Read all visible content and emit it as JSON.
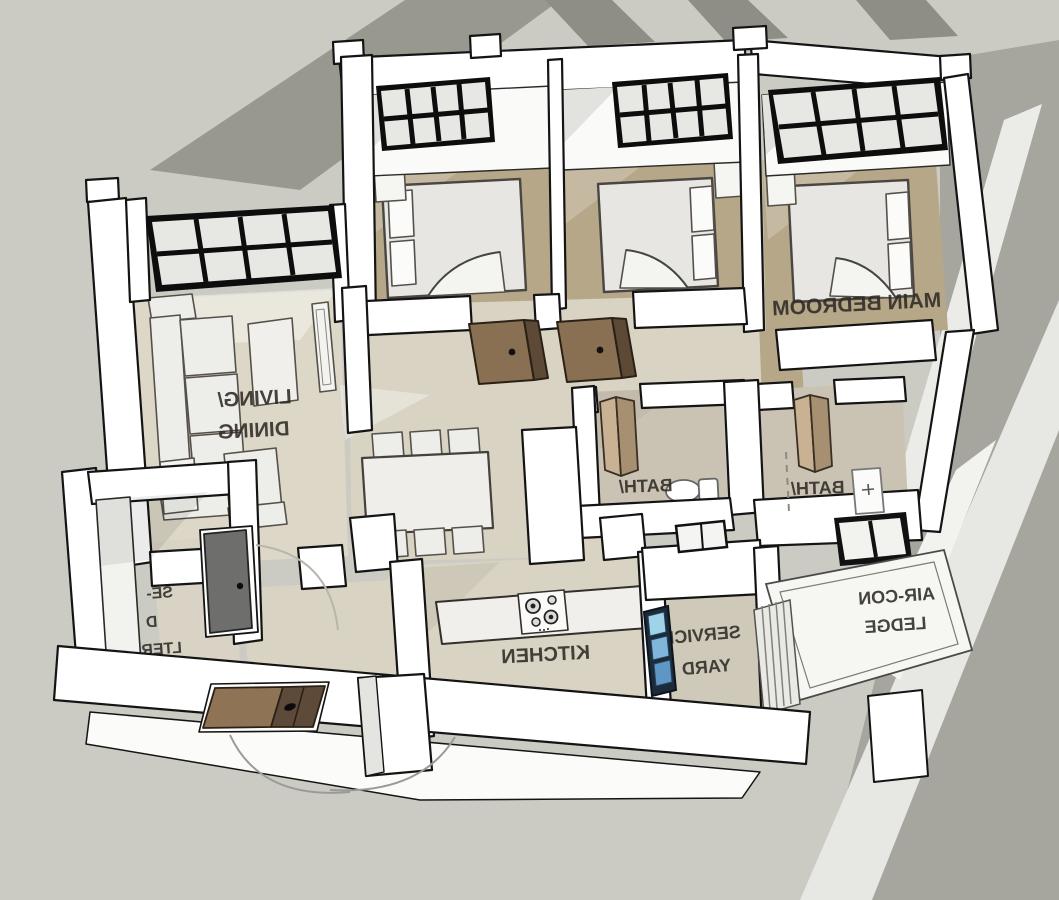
{
  "scene": {
    "type": "3d-isometric-floor-plan",
    "style": "sketchup-render, horizontally mirrored text",
    "rooms_visible": [
      "LIVING/ DINING",
      "BEDROOM (unlabeled)",
      "BEDROOM (unlabeled)",
      "MAIN BEDROOM",
      "BATH/",
      "BATH/",
      "KITCHEN",
      "SERVICE YARD",
      "AIR-CON LEDGE",
      "HOUSEHOLD SHELTER (label partially hidden by wall)"
    ],
    "objects": [
      "double-bed-icon x3",
      "sofa-icon",
      "armchair-icon",
      "coffee-table-icon",
      "tv-console-icon",
      "side-table-icon",
      "dining-table-icon",
      "dining-chair-icon x6",
      "kitchen-counter-icon",
      "cooktop-icon",
      "toilet-icon",
      "bifold-door-icon x2",
      "swing-door-icon x3",
      "steel-door-icon",
      "louver-window-icon",
      "grid-window-icon x4",
      "aircon-grille-icon",
      "door-swing-arc x3"
    ]
  },
  "labels": {
    "living_line1": "LIVING/",
    "living_line2": "DINING",
    "main_bedroom": "MAIN BEDROOM",
    "bath1": "BATH/",
    "bath2": "BATH/",
    "kitchen": "KITCHEN",
    "service_line1": "SERVICE",
    "service_line2": "YARD",
    "aircon_line1": "AIR-CON",
    "aircon_line2": "LEDGE",
    "shelter_frag1": "SE-",
    "shelter_frag2": "D",
    "shelter_frag3": "LTER"
  },
  "colors": {
    "background": "#cbcbc4",
    "shadow_dark": "#98988f",
    "shadow_mid": "#a6a69f",
    "light_streak": "#ebebe7",
    "wall": "#ffffff",
    "outline": "#141414",
    "floor_living": "#dcd7c6",
    "floor_bedroom": "#b5a787",
    "floor_bath": "#cac3b4",
    "window_frame": "#0d0d0d",
    "glass": "#e7e7e3",
    "door_brown": "#8a7052",
    "door_brown_dark": "#5c4936",
    "bifold_door": "#c3aa8a",
    "steel_door": "#6e6e6c",
    "louver_blue": "#7fb6d9",
    "ledge_white": "#f6f6f3",
    "label_text": "#2e2b26"
  }
}
